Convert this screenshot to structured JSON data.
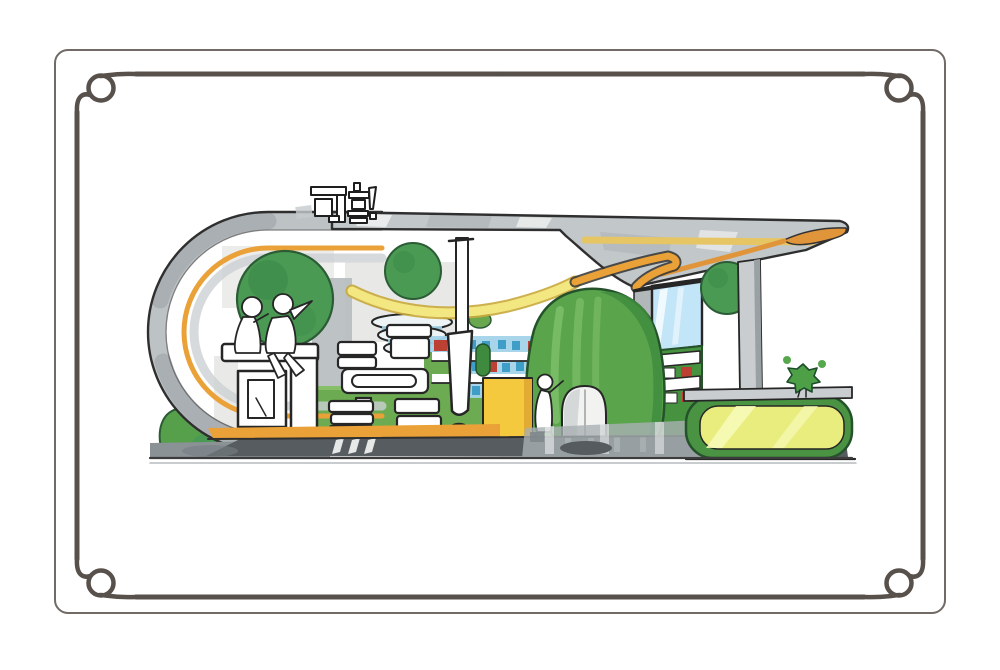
{
  "artwork": {
    "medium": "hand-drawn marker rendering",
    "subject": "exhibition booth concept sketch in ornamental frame",
    "roof_sign": {
      "text": "可靠!"
    },
    "giant_letters": {
      "text": "可靠!"
    },
    "palette": {
      "ink": "#262626",
      "frame_border": "#57504b",
      "shell_grey": "#bdc2c4",
      "stripe_orange": "#e9a138",
      "ribbon_yellow": "#f2e781",
      "kiosk_yellow": "#f4c93e",
      "tree_green": "#4a9a53",
      "dome_green": "#5aa44c",
      "grass_green": "#6cab51",
      "counter_green": "#4a9342",
      "counter_face": "#e9ed7e",
      "shelf_blue": "#a3d3e8",
      "product_blue": "#3f9ec7",
      "product_red": "#bc4034",
      "window_blue": "#c2e5f8",
      "platform_grey": "#5c6165",
      "paper_white": "#ffffff"
    },
    "objects": [
      "looped capsule shell",
      "canopy roof",
      "roof sign",
      "trees",
      "seated figures",
      "giant letter furniture",
      "display shelves",
      "disc display",
      "exclamation pole",
      "ceiling ribbon",
      "green dome pavilion",
      "window panel",
      "product shelf unit",
      "yellow kiosk",
      "standing figure",
      "support column",
      "service counter",
      "desk plant",
      "shrub",
      "base platform",
      "ground shadow"
    ]
  }
}
